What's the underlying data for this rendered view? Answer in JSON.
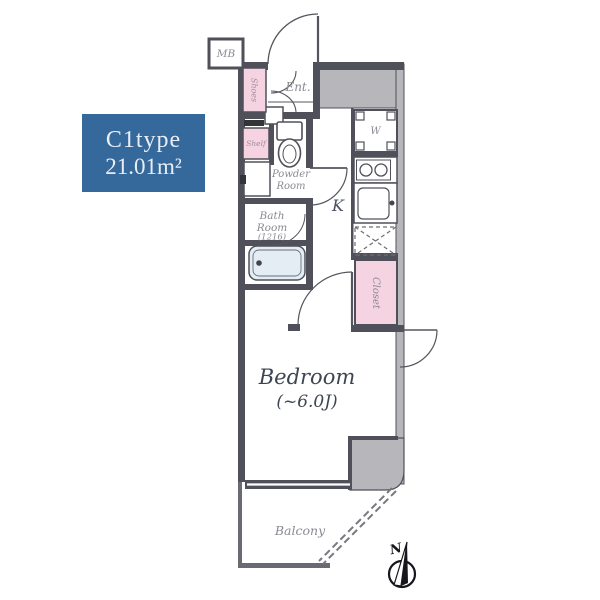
{
  "plan": {
    "type_label": "C1type",
    "area_label": "21.01m²",
    "rooms": {
      "mb": "MB",
      "entrance": "Ent.",
      "shoes": "Shoes",
      "shelf": "Shelf",
      "powder_line1": "Powder",
      "powder_line2": "Room",
      "bath_line1": "Bath",
      "bath_line2": "Room",
      "bath_size": "(1216)",
      "kitchen": "K",
      "washer": "W",
      "closet": "Closet",
      "bedroom": "Bedroom",
      "bedroom_size": "(~6.0J)",
      "balcony": "Balcony",
      "compass_north": "N"
    },
    "colors": {
      "accent_blue": "#35689b",
      "pink": "#f6d3e0",
      "wall": "#50505a",
      "gray_fill": "#b6b6bb",
      "tub_fill": "#e4edf3"
    }
  }
}
